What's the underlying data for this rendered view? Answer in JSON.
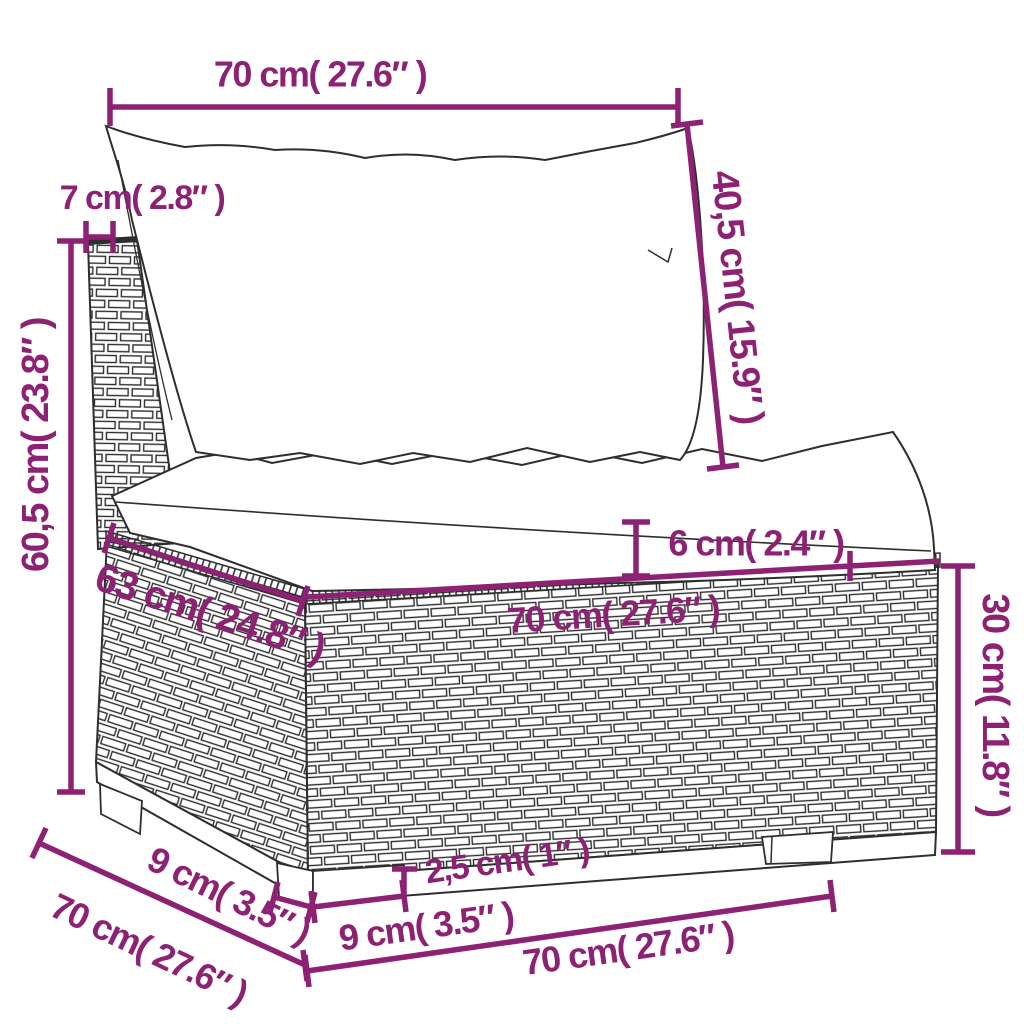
{
  "diagram": {
    "drawing_name": "poly-rattan-sofa-middle-section-with-cushions",
    "colors": {
      "accent": "#8d2173",
      "line": "#2e2e2e",
      "background": "#ffffff"
    },
    "dimensions": [
      {
        "id": "back-cushion-width",
        "placement": "top",
        "label": "70 cm( 27.6″ )",
        "cm": "70",
        "inch": "27.6"
      },
      {
        "id": "frame-top-depth",
        "placement": "upper-left",
        "label": "7 cm( 2.8″ )",
        "cm": "7",
        "inch": "2.8"
      },
      {
        "id": "overall-height",
        "placement": "left-vertical",
        "label": "60,5 cm( 23.8″ )",
        "cm": "60,5",
        "inch": "23.8"
      },
      {
        "id": "back-cushion-height",
        "placement": "upper-right-vertical",
        "label": "40,5 cm( 15.9″ )",
        "cm": "40,5",
        "inch": "15.9"
      },
      {
        "id": "seat-cushion-thickness",
        "placement": "middle",
        "label": "6 cm( 2.4″ )",
        "cm": "6",
        "inch": "2.4"
      },
      {
        "id": "seat-depth",
        "placement": "middle-left-diagonal",
        "label": "63 cm( 24.8″ )",
        "cm": "63",
        "inch": "24.8"
      },
      {
        "id": "seat-width",
        "placement": "middle-front-edge",
        "label": "70 cm( 27.6″ )",
        "cm": "70",
        "inch": "27.6"
      },
      {
        "id": "base-height",
        "placement": "right-vertical",
        "label": "30 cm( 11.8″ )",
        "cm": "30",
        "inch": "11.8"
      },
      {
        "id": "leg-height",
        "placement": "bottom-center",
        "label": "2,5 cm( 1″ )",
        "cm": "2,5",
        "inch": "1"
      },
      {
        "id": "leg-depth",
        "placement": "bottom-left-diagonal",
        "label": "9 cm( 3.5″ )",
        "cm": "9",
        "inch": "3.5"
      },
      {
        "id": "leg-width",
        "placement": "bottom-center",
        "label": "9 cm( 3.5″ )",
        "cm": "9",
        "inch": "3.5"
      },
      {
        "id": "overall-depth",
        "placement": "bottom-left-diagonal",
        "label": "70 cm( 27.6″ )",
        "cm": "70",
        "inch": "27.6"
      },
      {
        "id": "base-width",
        "placement": "bottom",
        "label": "70 cm( 27.6″ )",
        "cm": "70",
        "inch": "27.6"
      }
    ]
  }
}
